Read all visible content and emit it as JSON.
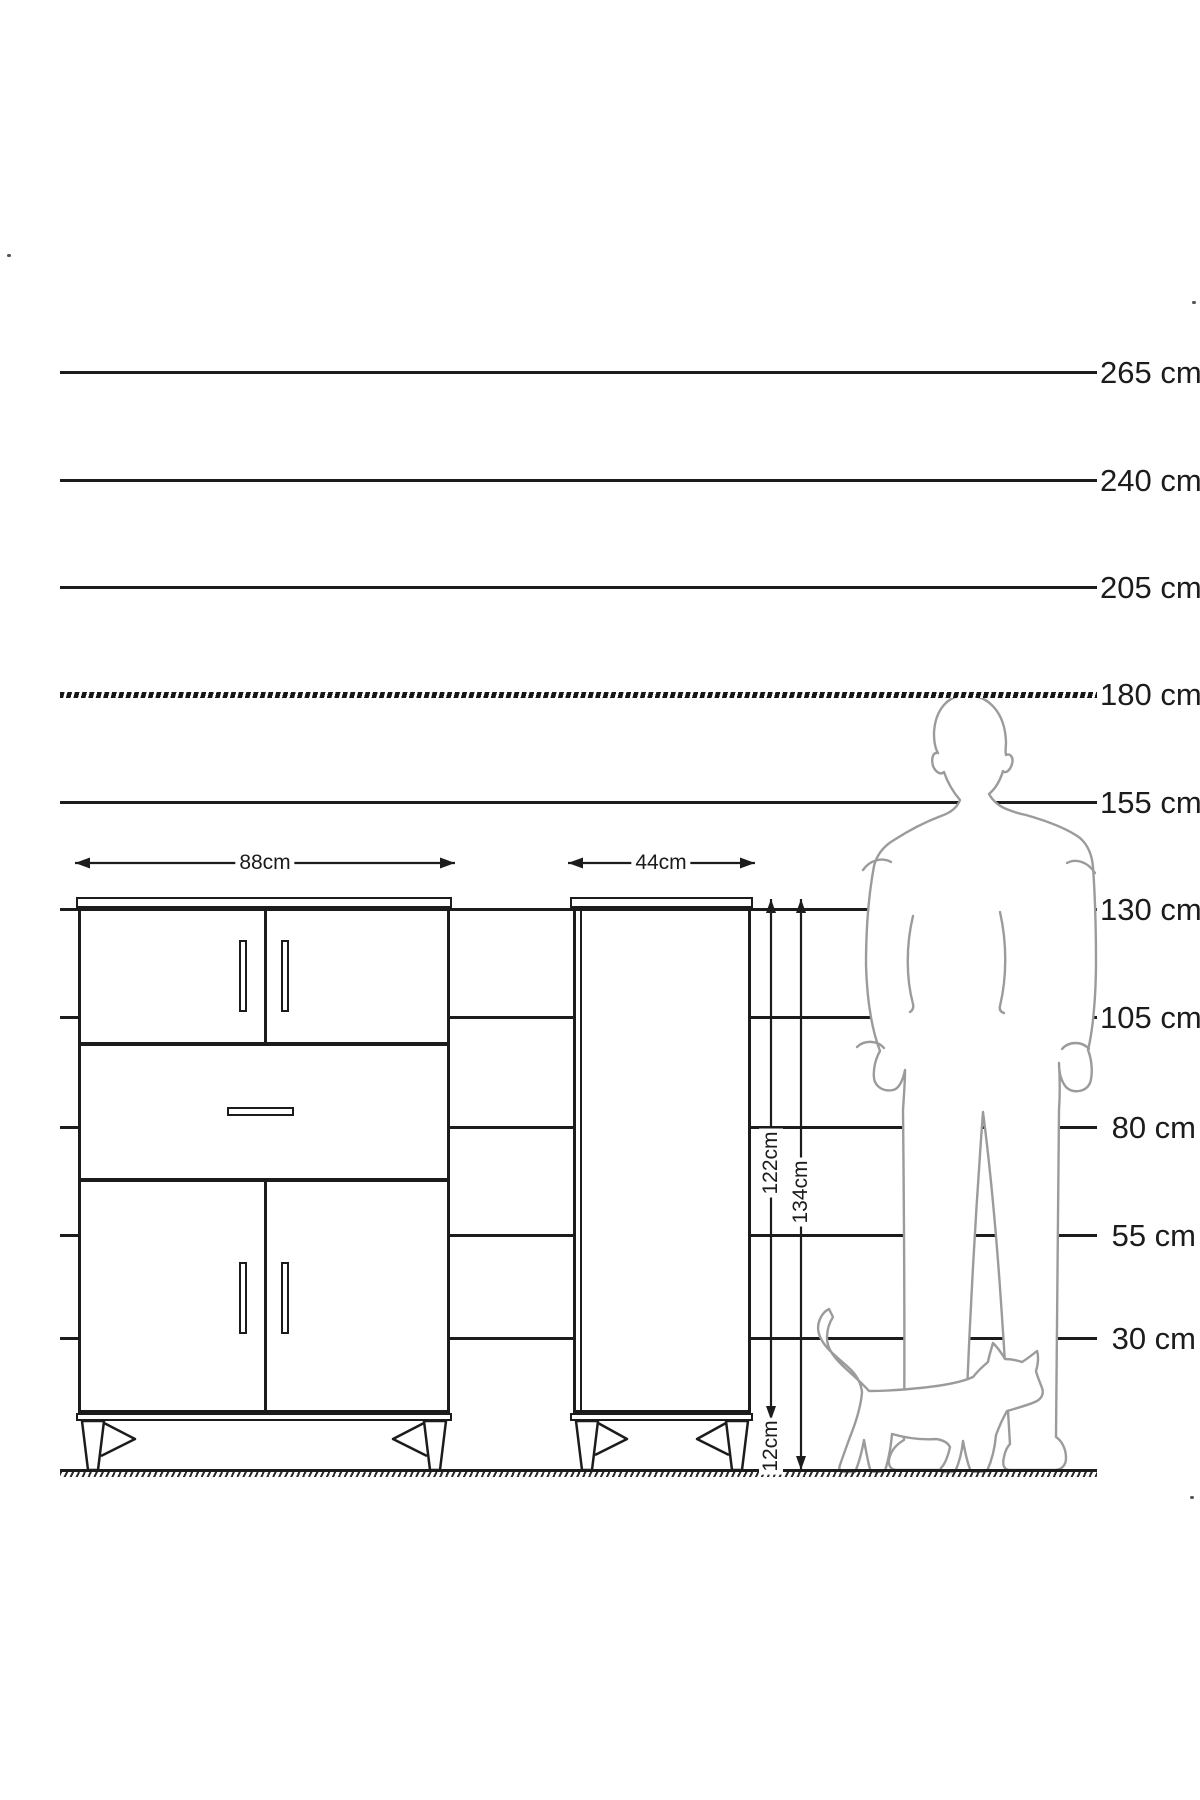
{
  "scale": {
    "lines": [
      {
        "label": "265 cm"
      },
      {
        "label": "240 cm"
      },
      {
        "label": "205 cm"
      },
      {
        "label": "180 cm"
      },
      {
        "label": "155 cm"
      },
      {
        "label": "130 cm"
      },
      {
        "label": "105 cm"
      },
      {
        "label": "80 cm"
      },
      {
        "label": "55 cm"
      },
      {
        "label": "30 cm"
      }
    ]
  },
  "dimensions": {
    "sideboard_width_label": "88cm",
    "cabinet_width_label": "44cm",
    "cabinet_body_height_label": "122cm",
    "cabinet_total_height_label": "134cm",
    "cabinet_leg_height_label": "12cm"
  },
  "colors": {
    "line": "#1c1c1c",
    "silhouette_outline": "#9b9b9b",
    "background": "#ffffff",
    "text": "#1c1c1c"
  }
}
